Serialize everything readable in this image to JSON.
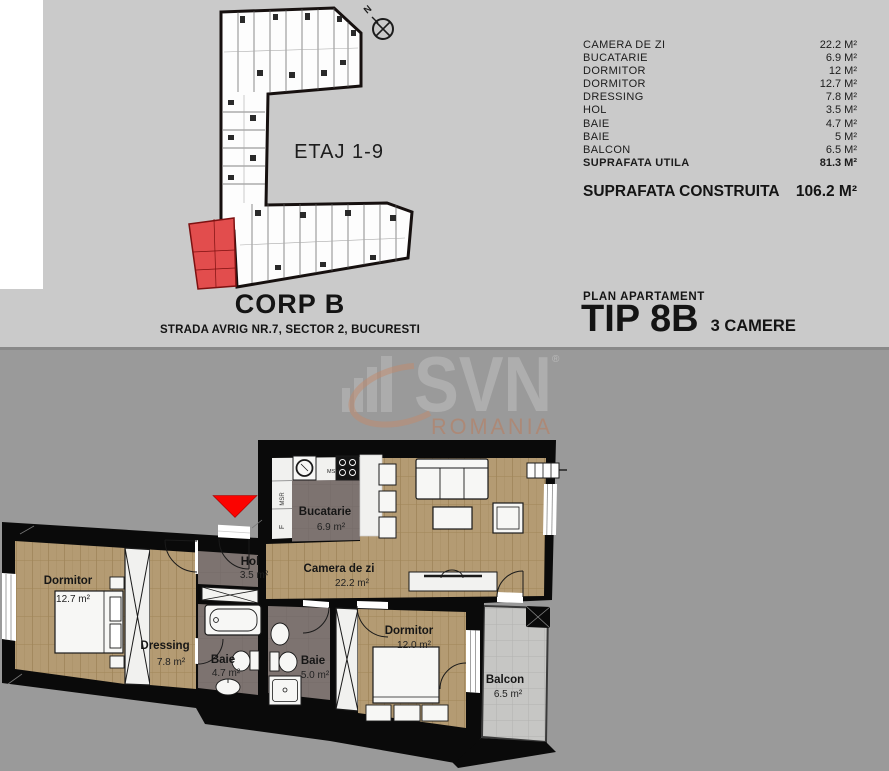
{
  "top": {
    "floor_label": "ETAJ 1-9",
    "compass_label": "N",
    "building_title": "CORP B",
    "address": "STRADA AVRIG NR.7, SECTOR 2, BUCURESTI",
    "area_table": {
      "rows": [
        {
          "label": "CAMERA DE ZI",
          "value": "22.2 M²"
        },
        {
          "label": "BUCATARIE",
          "value": "6.9 M²"
        },
        {
          "label": "DORMITOR",
          "value": "12 M²"
        },
        {
          "label": "DORMITOR",
          "value": "12.7 M²"
        },
        {
          "label": "DRESSING",
          "value": "7.8 M²"
        },
        {
          "label": "HOL",
          "value": "3.5 M²"
        },
        {
          "label": "BAIE",
          "value": "4.7 M²"
        },
        {
          "label": "BAIE",
          "value": "5 M²"
        },
        {
          "label": "BALCON",
          "value": "6.5 M²"
        },
        {
          "label": "SUPRAFATA UTILA",
          "value": "81.3 M²"
        }
      ]
    },
    "built_area": {
      "label": "SUPRAFATA CONSTRUITA",
      "value": "106.2 M²"
    },
    "plan_label": "PLAN APARTAMENT",
    "type_label": "TIP 8B",
    "rooms_label": "3 CAMERE"
  },
  "watermark": {
    "brand": "SVN",
    "region": "ROMANIA",
    "reg": "®"
  },
  "floorplan": {
    "entrance_color": "#fb0300",
    "highlight_unit_color": "#e24d4d",
    "rooms": [
      {
        "name": "Dormitor",
        "area": "12.7 m²"
      },
      {
        "name": "Dressing",
        "area": "7.8 m²"
      },
      {
        "name": "Hol",
        "area": "3.5 m²"
      },
      {
        "name": "Baie",
        "area": "4.7 m²"
      },
      {
        "name": "Baie",
        "area": "5.0 m²"
      },
      {
        "name": "Bucatarie",
        "area": "6.9 m²"
      },
      {
        "name": "Camera de zi",
        "area": "22.2 m²"
      },
      {
        "name": "Dormitor",
        "area": "12.0 m²"
      },
      {
        "name": "Balcon",
        "area": "6.5 m²"
      }
    ],
    "kitchen": {
      "msv": "MSV",
      "msr": "MSR",
      "f": "F"
    }
  }
}
